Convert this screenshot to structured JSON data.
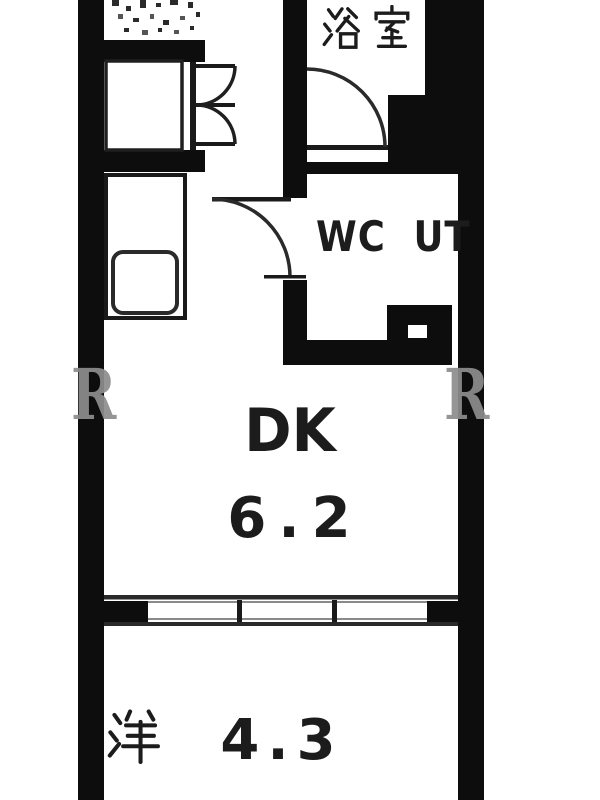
{
  "colors": {
    "wall": "#0d0d0d",
    "line": "#1f1f1f",
    "watermark": "#8d8d8d",
    "background": "#ffffff"
  },
  "watermark": {
    "letter": "R"
  },
  "floorplan": {
    "rooms": {
      "bathroom": {
        "label": "浴室"
      },
      "wc_ut": {
        "label": "WC UT"
      },
      "dk": {
        "label": "DK",
        "area": "6.2"
      },
      "western": {
        "label": "洋",
        "area": "4.3"
      }
    }
  }
}
